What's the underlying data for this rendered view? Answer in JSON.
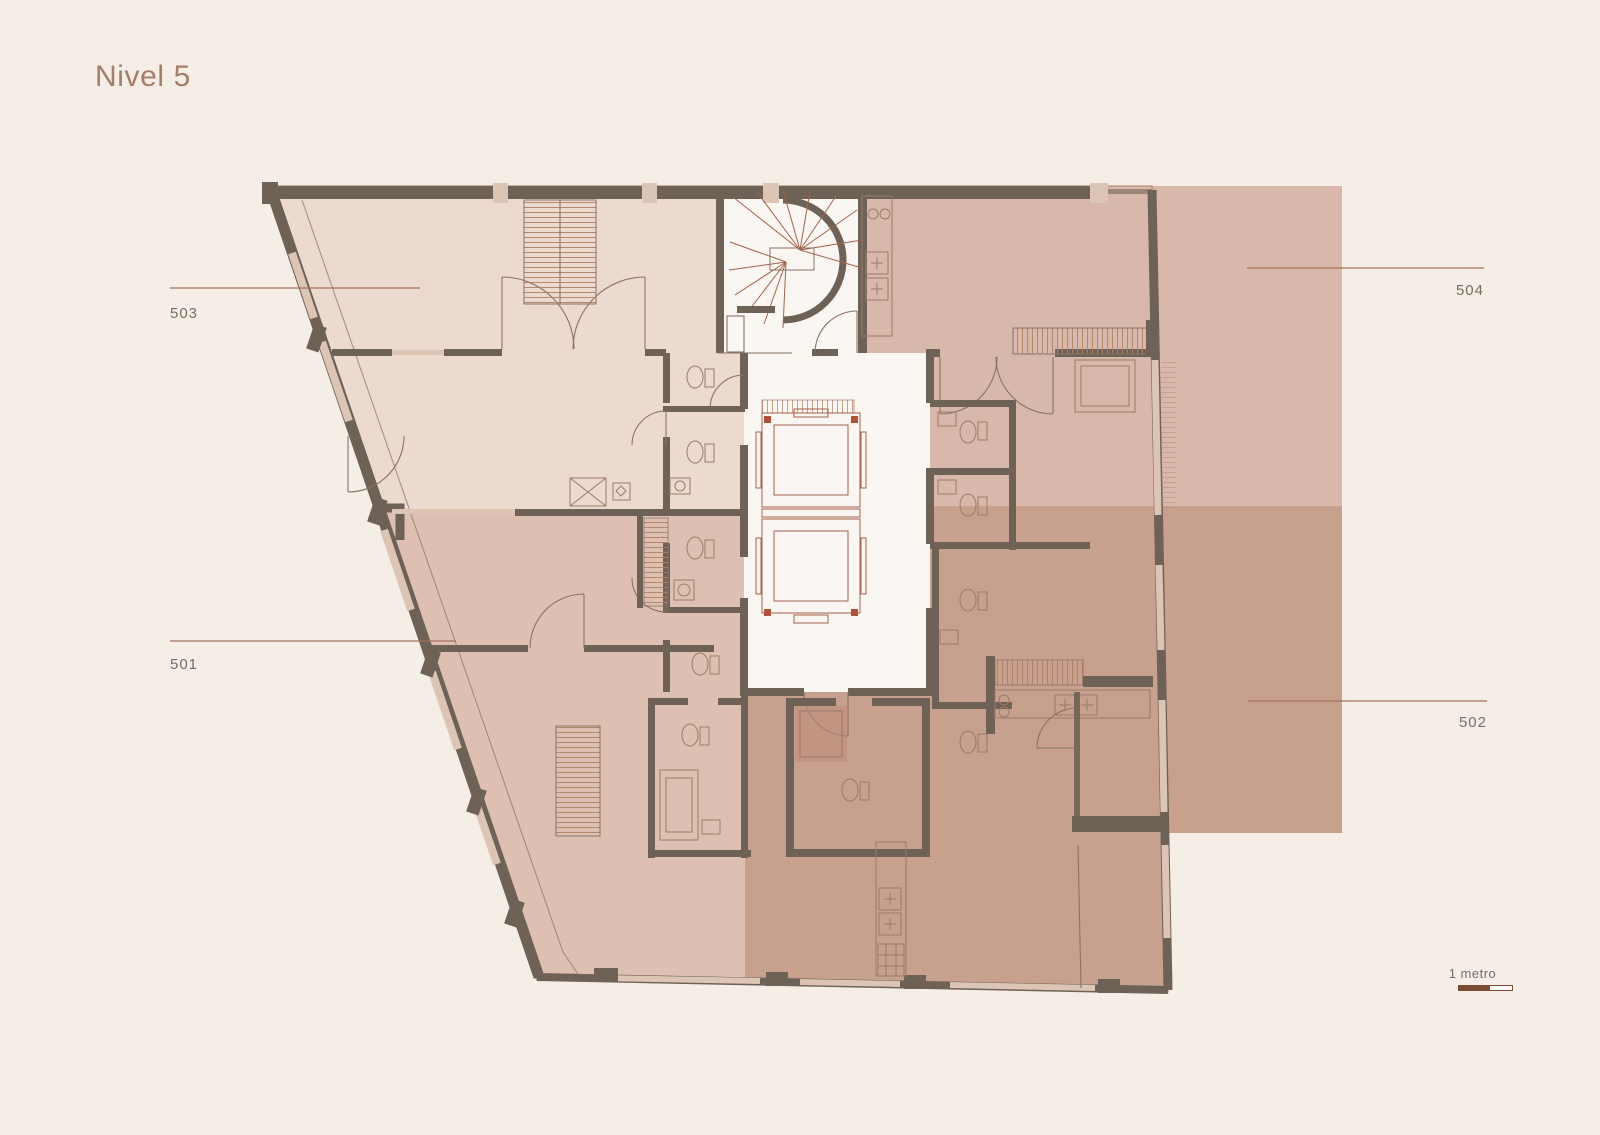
{
  "title": "Nivel 5",
  "floorplan": {
    "units": [
      {
        "number": "503",
        "side": "left-top"
      },
      {
        "number": "501",
        "side": "left-bottom"
      },
      {
        "number": "504",
        "side": "right-top"
      },
      {
        "number": "502",
        "side": "right-bottom"
      }
    ],
    "features": [
      "spiral-staircase",
      "two-elevators",
      "bathrooms",
      "kitchens",
      "closets"
    ]
  },
  "scale": {
    "label": "1 metro"
  },
  "colors": {
    "background": "#f4eee7",
    "title_text": "#a47e68",
    "label_text": "#7c6b61",
    "leader_line": "#a5705a",
    "unit_503": "#ecdacf",
    "unit_501": "#dec0b2",
    "unit_504": "#d7b8ab",
    "unit_502": "#c7a08e",
    "core_white": "#faf6f1",
    "wall_dark": "#6e6156",
    "window_light": "#dcc5b5",
    "line_thin": "#8a7365",
    "line_red": "#a4634b",
    "hatch": "#b08063",
    "outline": "#b6907c",
    "scale_bar": "#7b4b34"
  }
}
